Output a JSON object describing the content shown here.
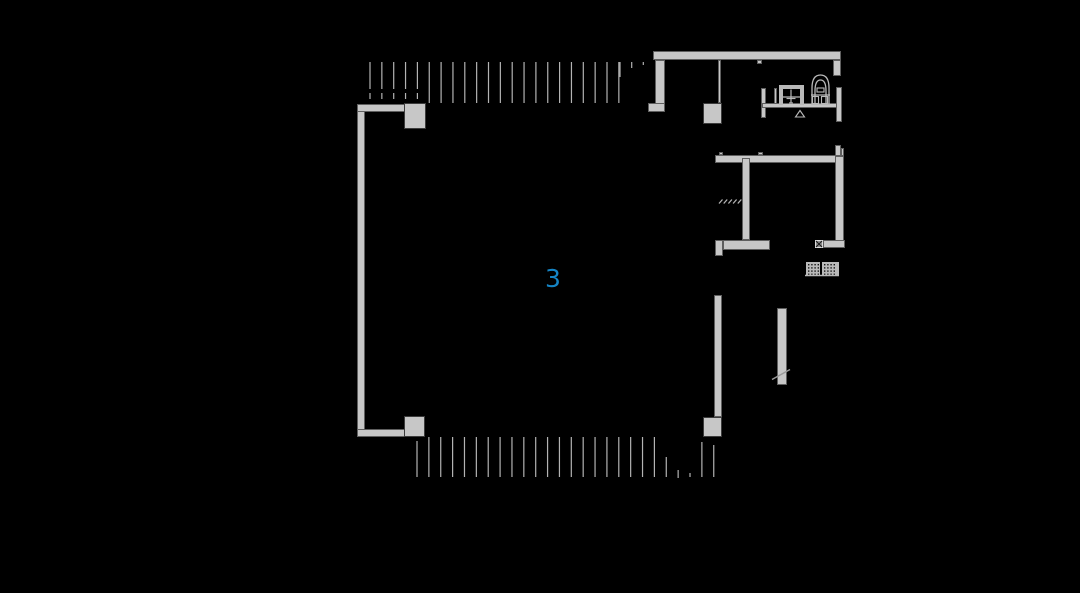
{
  "page": {
    "type": "cad-floor-plan-view"
  },
  "label": {
    "text": "3",
    "color": "#1585c6"
  },
  "colors": {
    "background": "#000000",
    "wall_fill": "#c7c7c7",
    "wall_edge": "#5f5f5f",
    "column_edge": "#3c3c3c",
    "hatch": "#b3b3b3",
    "fixture": "#b9b9b9",
    "dot": "#151515"
  },
  "walls": [
    {
      "name": "left-wall",
      "x": 357,
      "y": 104,
      "w": 8,
      "h": 333
    },
    {
      "name": "left-wall-top-return",
      "x": 357,
      "y": 104,
      "w": 49,
      "h": 8
    },
    {
      "name": "left-wall-bottom-return",
      "x": 357,
      "y": 429,
      "w": 49,
      "h": 8
    },
    {
      "name": "column-top-left",
      "x": 404,
      "y": 103,
      "w": 22,
      "h": 26,
      "edge": "column_edge"
    },
    {
      "name": "column-bottom-left",
      "x": 404,
      "y": 416,
      "w": 21,
      "h": 21,
      "edge": "column_edge"
    },
    {
      "name": "top-wall",
      "x": 653,
      "y": 51,
      "w": 188,
      "h": 9
    },
    {
      "name": "top-wall-left-pier",
      "x": 655,
      "y": 60,
      "w": 10,
      "h": 44
    },
    {
      "name": "top-wall-left-pier-foot",
      "x": 648,
      "y": 103,
      "w": 17,
      "h": 9
    },
    {
      "name": "top-partition-line",
      "x": 718,
      "y": 60,
      "w": 3,
      "h": 43
    },
    {
      "name": "column-top-middle",
      "x": 703,
      "y": 103,
      "w": 19,
      "h": 21,
      "edge": "column_edge"
    },
    {
      "name": "top-wall-right-return",
      "x": 833,
      "y": 60,
      "w": 8,
      "h": 16
    },
    {
      "name": "bath-wall-left",
      "x": 761,
      "y": 88,
      "w": 5,
      "h": 30
    },
    {
      "name": "bath-partition",
      "x": 774,
      "y": 88,
      "w": 3,
      "h": 17
    },
    {
      "name": "bath-counter",
      "x": 762,
      "y": 103,
      "w": 80,
      "h": 5
    },
    {
      "name": "bath-wall-right",
      "x": 836,
      "y": 87,
      "w": 6,
      "h": 35
    },
    {
      "name": "room-top-wall",
      "x": 715,
      "y": 155,
      "w": 128,
      "h": 8
    },
    {
      "name": "room-top-wall-tick-a",
      "x": 719,
      "y": 152,
      "w": 4,
      "h": 3
    },
    {
      "name": "room-top-wall-tick-b",
      "x": 758,
      "y": 152,
      "w": 5,
      "h": 3
    },
    {
      "name": "top-wall-tick",
      "x": 757,
      "y": 60,
      "w": 5,
      "h": 4
    },
    {
      "name": "room-right-wall",
      "x": 835,
      "y": 156,
      "w": 9,
      "h": 92
    },
    {
      "name": "room-right-wall-top-stub",
      "x": 835,
      "y": 145,
      "w": 6,
      "h": 11
    },
    {
      "name": "room-right-wall-step",
      "x": 841,
      "y": 148,
      "w": 3,
      "h": 8
    },
    {
      "name": "room-bottom-right-stub",
      "x": 823,
      "y": 240,
      "w": 22,
      "h": 8
    },
    {
      "name": "room-middle-wall",
      "x": 742,
      "y": 158,
      "w": 8,
      "h": 82
    },
    {
      "name": "room-bottom-wall",
      "x": 723,
      "y": 240,
      "w": 47,
      "h": 10
    },
    {
      "name": "room-bottom-left-stub",
      "x": 715,
      "y": 240,
      "w": 8,
      "h": 16
    },
    {
      "name": "lower-wall",
      "x": 714,
      "y": 295,
      "w": 8,
      "h": 122
    },
    {
      "name": "column-bottom-right",
      "x": 703,
      "y": 417,
      "w": 19,
      "h": 20,
      "edge": "column_edge"
    },
    {
      "name": "stair-rail-wall",
      "x": 777,
      "y": 308,
      "w": 10,
      "h": 77
    }
  ],
  "hatch_top": {
    "name": "top-glazing-hatch",
    "x_start": 370,
    "spacing": 11.85,
    "count": 22,
    "y": [
      62,
      103
    ],
    "dashed_first": 5,
    "dash_segments": [
      [
        62,
        89
      ],
      [
        93,
        99
      ]
    ],
    "extra_lines": [
      {
        "x": 620.0,
        "y": [
          62,
          77
        ]
      },
      {
        "x": 631.7,
        "y": [
          62,
          68
        ]
      },
      {
        "x": 643.3,
        "y": [
          62,
          65
        ]
      }
    ]
  },
  "hatch_bottom": {
    "name": "bottom-glazing-hatch",
    "x_start": 417,
    "spacing": 11.87,
    "count": 26,
    "y": [
      437,
      477
    ],
    "overrides": {
      "0": [
        441,
        477
      ],
      "21": [
        457,
        477
      ],
      "22": [
        470,
        478
      ],
      "23": [
        473,
        477
      ],
      "24": [
        442,
        477
      ],
      "25": [
        445,
        477
      ]
    }
  },
  "door_hatch": {
    "name": "threshold-hatch",
    "x_start": 719,
    "spacing": 4.7,
    "count": 5,
    "dx": 3.5,
    "y1": 203.5,
    "y2": 199.5
  },
  "fixtures": {
    "sink": {
      "name": "sink-unit",
      "rects": [
        [
          779,
          85,
          25,
          4
        ],
        [
          779,
          85,
          4,
          20
        ],
        [
          800,
          85,
          4,
          20
        ]
      ],
      "lines": [
        [
          781,
          97,
          802,
          97
        ],
        [
          791,
          89.5,
          791,
          103
        ],
        [
          786.5,
          98.5,
          795.5,
          98.5
        ],
        [
          789,
          103,
          793,
          103
        ]
      ]
    },
    "toilet": {
      "name": "toilet-unit",
      "paths": [
        "M812 104.5 V88 Q812 75 820.5 75 Q829 75 829 88 V104.5",
        "M815 104.5 V91 Q815 80 820.5 80 Q826 80 826 91 V104.5"
      ],
      "lines": [
        [
          811,
          95,
          830,
          95
        ],
        [
          811,
          104.5,
          830,
          104.5
        ]
      ],
      "rects_outline": [
        [
          812.5,
          96.5,
          6,
          7
        ],
        [
          821.5,
          96.5,
          6,
          7
        ],
        [
          817,
          88,
          7,
          4
        ]
      ]
    },
    "heater": {
      "name": "heater-grill",
      "panels": [
        [
          806,
          262,
          14,
          13
        ],
        [
          822,
          262,
          14,
          13
        ]
      ],
      "bar": [
        836,
        262,
        3,
        14
      ],
      "base_line": [
        805,
        275.5,
        839,
        275.5
      ],
      "dot_spacing": 3.2,
      "dot_size": 1.4
    }
  },
  "annotations": {
    "x_box": {
      "name": "x-box-symbol",
      "x": 815,
      "y": 240,
      "w": 8,
      "h": 8
    },
    "break_line": {
      "name": "break-line",
      "x1": 772,
      "y1": 379.5,
      "x2": 790,
      "y2": 369.5
    },
    "triangle": {
      "name": "level-marker-triangle",
      "points": "800,110.5 795.5,117 804.5,117"
    }
  }
}
